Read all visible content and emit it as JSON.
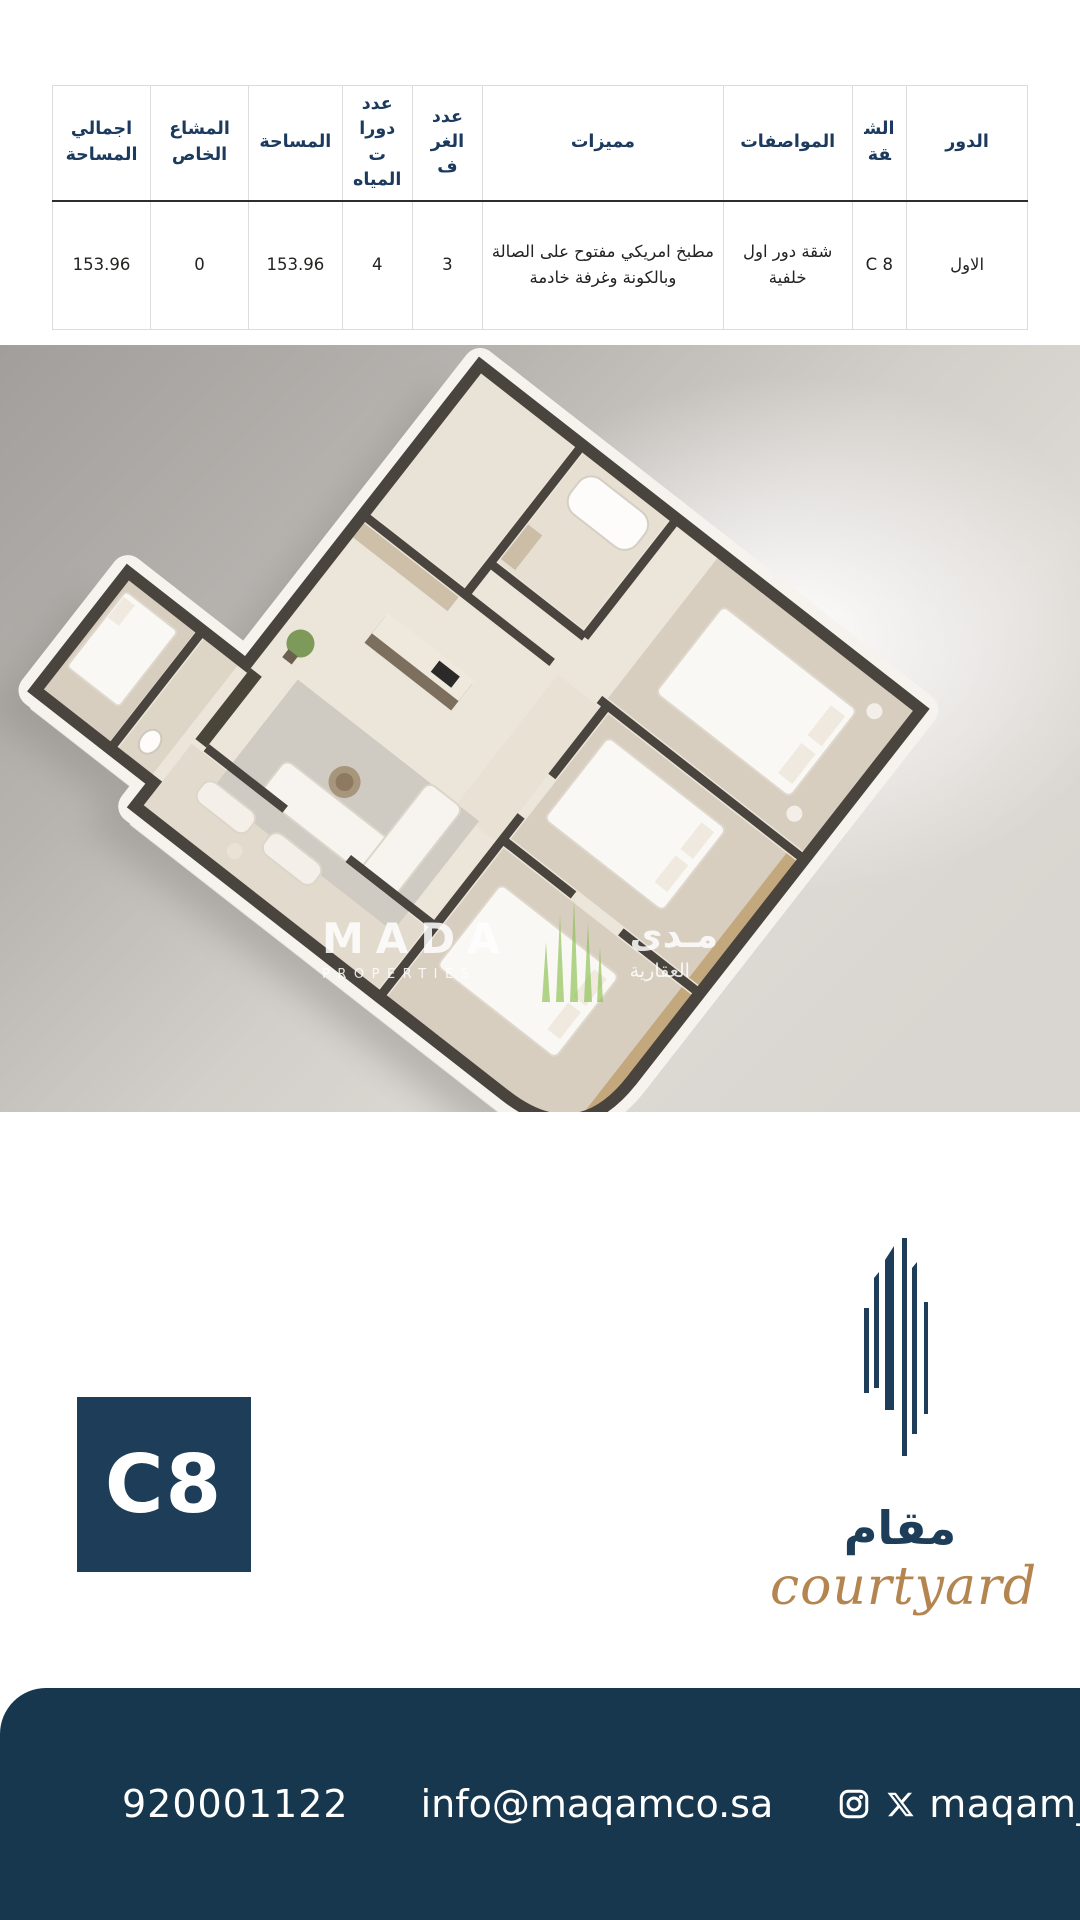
{
  "table": {
    "headers": [
      "الدور",
      "الشقة",
      "المواصفات",
      "مميزات",
      "عدد الغرف",
      "عدد دورات المياه",
      "المساحة",
      "المشاع الخاص",
      "اجمالي المساحة"
    ],
    "row": [
      "الاول",
      "C 8",
      "شقة دور اول خلفية",
      "مطبخ امريكي مفتوح على الصالة  وبالكونة وغرفة خادمة",
      "3",
      "4",
      "153.96",
      "0",
      "153.96"
    ]
  },
  "floorplan": {
    "watermark": {
      "brand": "MADA",
      "brand_sub": "PROPERTIES",
      "brand_ar": "مـدى",
      "brand_ar_sub": "العقارية"
    }
  },
  "unit": {
    "badge": "C8"
  },
  "brand": {
    "name_ar": "مقام",
    "tagline": "courtyard"
  },
  "footer": {
    "phone": "920001122",
    "email": "info@maqamco.sa",
    "handle": "maqam_co"
  },
  "colors": {
    "footer_navy": "#16374d",
    "badge_navy": "#1e3d58",
    "header_text": "#1c3a5e",
    "gold": "#b5854f",
    "watermark_green": "#8cc152",
    "wall": "#49443d"
  }
}
